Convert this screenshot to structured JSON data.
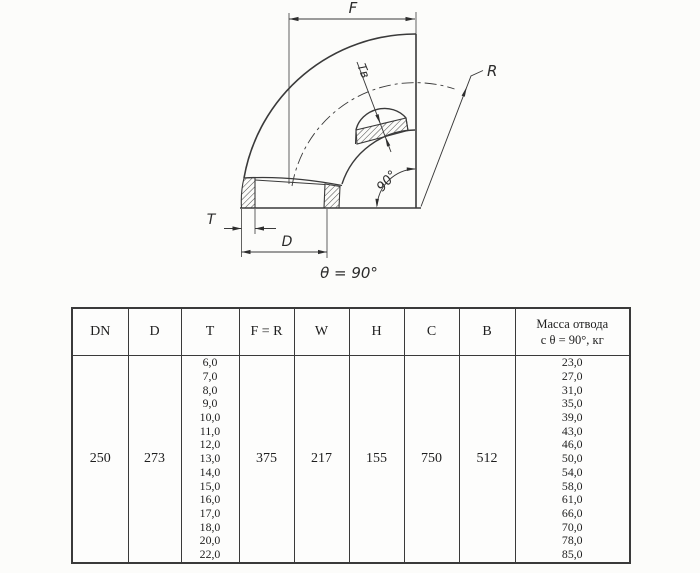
{
  "drawing": {
    "labels": {
      "f": "F",
      "r": "R",
      "t": "T",
      "d": "D",
      "tv": "Tв",
      "angle_90": "90°",
      "theta_note": "θ = 90°"
    },
    "line_color": "#3a3a3a"
  },
  "table": {
    "headers": [
      "DN",
      "D",
      "T",
      "F = R",
      "W",
      "H",
      "C",
      "B",
      "Масса отвода\nс θ =  90°, кг"
    ],
    "row": {
      "dn": "250",
      "d": "273",
      "t_values": [
        "6,0",
        "7,0",
        "8,0",
        "9,0",
        "10,0",
        "11,0",
        "12,0",
        "13,0",
        "14,0",
        "15,0",
        "16,0",
        "17,0",
        "18,0",
        "20,0",
        "22,0"
      ],
      "f_r": "375",
      "w": "217",
      "h": "155",
      "c": "750",
      "b": "512",
      "mass_values": [
        "23,0",
        "27,0",
        "31,0",
        "35,0",
        "39,0",
        "43,0",
        "46,0",
        "50,0",
        "54,0",
        "58,0",
        "61,0",
        "66,0",
        "70,0",
        "78,0",
        "85,0"
      ]
    }
  }
}
